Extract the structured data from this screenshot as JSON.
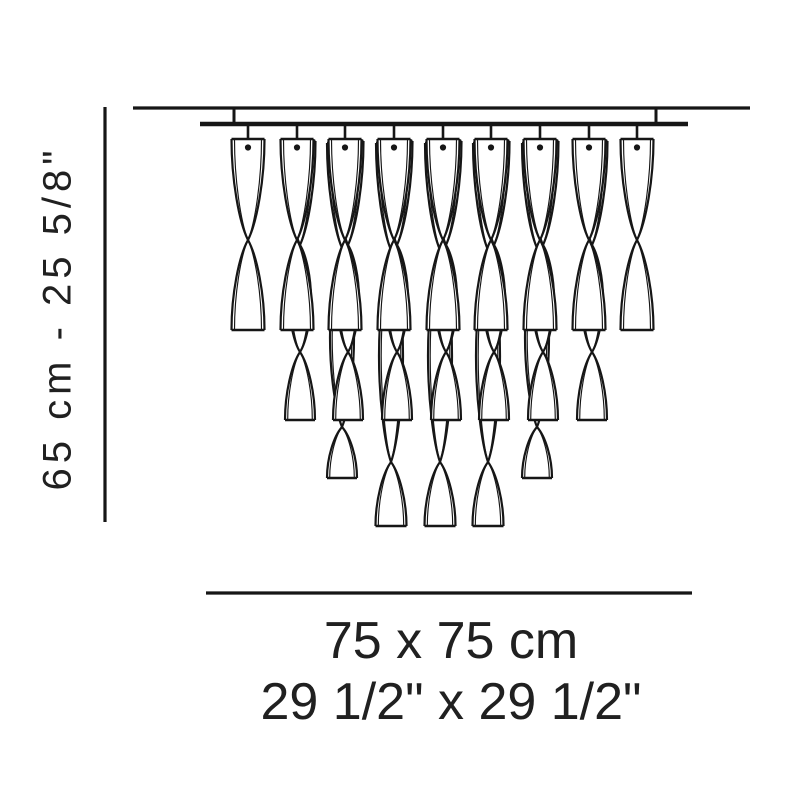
{
  "labels": {
    "height": "65 cm - 25 5/8\"",
    "width_cm": "75 x 75 cm",
    "width_in": "29 1/2\" x 29 1/2\""
  },
  "colors": {
    "line": "#161616",
    "text": "#202020",
    "bg": "#ffffff"
  },
  "fixture": {
    "ceiling": {
      "x1": 133,
      "y": 108,
      "x2": 750
    },
    "rail": {
      "x1": 200,
      "y": 124,
      "x2": 688
    },
    "rail_drops": [
      234,
      656
    ],
    "columns_x": [
      248,
      297,
      345,
      394,
      443,
      491,
      540,
      589,
      637
    ],
    "tiers_by_column": [
      [
        0
      ],
      [
        1,
        0
      ],
      [
        2,
        1,
        0
      ],
      [
        3,
        1,
        0
      ],
      [
        3,
        1,
        0
      ],
      [
        3,
        1,
        0
      ],
      [
        2,
        1,
        0
      ],
      [
        1,
        0
      ],
      [
        0
      ]
    ],
    "piece_types": [
      {
        "y0": 139,
        "y1": 330,
        "wt": 16.5,
        "wb": 16.5,
        "cross": [
          240
        ],
        "bulge": 11,
        "dx": 0
      },
      {
        "y0": 141,
        "y1": 420,
        "wt": 15.5,
        "wb": 15,
        "cross": [
          245,
          352
        ],
        "bulge": 11,
        "dx": 3
      },
      {
        "y0": 143,
        "y1": 478,
        "wt": 15,
        "wb": 15,
        "cross": [
          248,
          427
        ],
        "bulge": 12,
        "dx": -3
      },
      {
        "y0": 143,
        "y1": 526,
        "wt": 15,
        "wb": 15.5,
        "cross": [
          250,
          462
        ],
        "bulge": 12,
        "dx": -3
      }
    ],
    "hole": {
      "cy": 147.5,
      "r": 3.1
    },
    "dim_height": {
      "x": 105,
      "y1": 107,
      "y2": 522
    },
    "dim_width": {
      "y": 593,
      "x1": 206,
      "x2": 692
    }
  }
}
